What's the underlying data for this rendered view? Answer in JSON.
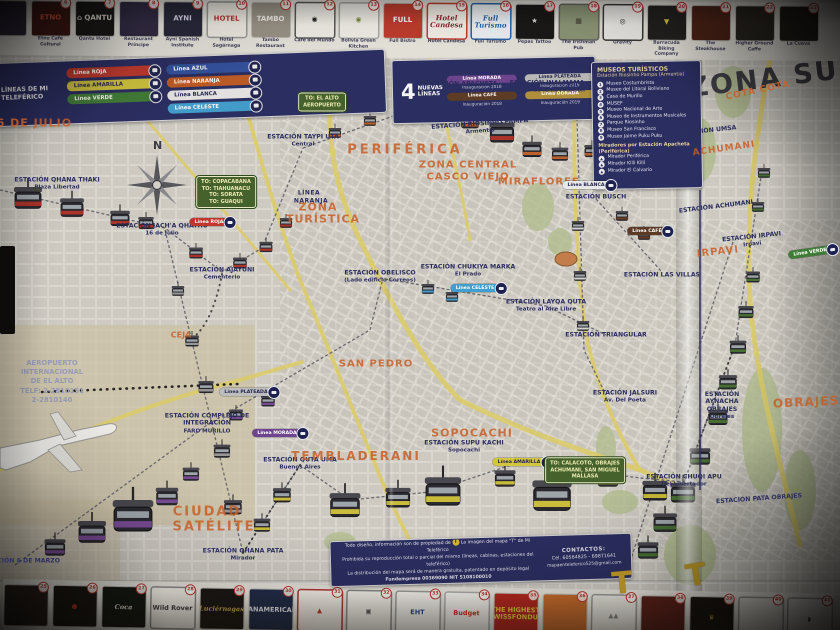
{
  "map": {
    "title": "LA PAZ",
    "right_title": "ZONA SUR",
    "compass_label": "N",
    "airport": {
      "lines": [
        "AEROPUERTO",
        "INTERNACIONAL",
        "DE EL ALTO",
        "TELF: 2-2810151",
        "2-2810140"
      ]
    },
    "stations": [
      {
        "name": "ESTACIÓN QHANA THAKI",
        "sub": "Plaza Libertad",
        "x": 57,
        "y": 184
      },
      {
        "name": "ESTACIÓN JACH'A QHATHU",
        "sub": "16 de Julio",
        "x": 162,
        "y": 230
      },
      {
        "name": "ESTACIÓN AJAYUNI",
        "sub": "Cementerio",
        "x": 222,
        "y": 274
      },
      {
        "name": "ESTACIÓN TAYPI UTA",
        "sub": "Central",
        "x": 303,
        "y": 141
      },
      {
        "name": "ESTACIÓN APACHETA",
        "sub": "Periférica",
        "x": 461,
        "y": 88
      },
      {
        "name": "ESTACIÓN INALMAMA",
        "sub": "Héroes de la Revolución",
        "x": 547,
        "y": 87
      },
      {
        "name": "ESTACIÓN RIOSINHO PAMPA",
        "sub": "Armentia",
        "x": 480,
        "y": 128,
        "rot": -4
      },
      {
        "name": "ESTACIÓN OBELISCO",
        "sub": "(Lado edificio Correos)",
        "x": 380,
        "y": 277
      },
      {
        "name": "ESTACIÓN CHUKIYA MARKA",
        "sub": "El Prado",
        "x": 468,
        "y": 271
      },
      {
        "name": "ESTACIÓN LAYQA QUTA",
        "sub": "Teatro al Aire Libre",
        "x": 546,
        "y": 306
      },
      {
        "name": "ESTACIÓN TRIANGULAR",
        "sub": "",
        "x": 606,
        "y": 335
      },
      {
        "name": "ESTACIÓN BUSCH",
        "sub": "",
        "x": 596,
        "y": 197
      },
      {
        "name": "ESTACIÓN LAS VILLAS",
        "sub": "",
        "x": 662,
        "y": 275
      },
      {
        "name": "ESTACIÓN SUPU KACHI",
        "sub": "Sopocachi",
        "x": 464,
        "y": 447
      },
      {
        "name": "ESTACIÓN QUTA UMA",
        "sub": "Buenos Aires",
        "x": 300,
        "y": 464
      },
      {
        "name": "ESTACIÓN QHANA PATA",
        "sub": "Mirador",
        "x": 243,
        "y": 555
      },
      {
        "name": "ESTACIÓN COMPLEJO DE INTEGRACIÓN",
        "sub": "FARO MURILLO",
        "x": 207,
        "y": 424,
        "w": 112
      },
      {
        "name": "ESTACIÓN JALSURI",
        "sub": "Av. Del Poeta",
        "x": 625,
        "y": 397
      },
      {
        "name": "ESTACIÓN CHUQI APU",
        "sub": "Del Libertador",
        "x": 684,
        "y": 481
      },
      {
        "name": "ESTACIÓN 6 DE MARZO",
        "sub": "",
        "x": 20,
        "y": 561
      },
      {
        "name": "ESTACIÓN UMSA",
        "sub": "",
        "x": 708,
        "y": 131,
        "rot": -6
      },
      {
        "name": "ESTACIÓN ACHUMANI",
        "sub": "",
        "x": 716,
        "y": 207,
        "rot": -7
      },
      {
        "name": "ESTACIÓN IRPAVI",
        "sub": "Irpavi",
        "x": 752,
        "y": 241,
        "rot": -6
      },
      {
        "name": "ESTACIÓN AYNACHA OBRAJES",
        "sub": "Obrajes",
        "x": 722,
        "y": 406,
        "w": 64
      },
      {
        "name": "ESTACIÓN PATA OBRAJES",
        "sub": "",
        "x": 759,
        "y": 499,
        "rot": -4
      }
    ],
    "zones": [
      {
        "label": "PERIFÉRICA",
        "x": 405,
        "y": 150,
        "fs": 13,
        "ls": 3
      },
      {
        "label": "ZONA CENTRAL",
        "x": 468,
        "y": 165,
        "fs": 10,
        "ls": 1
      },
      {
        "label": "CASCO VIEJO",
        "x": 468,
        "y": 177,
        "fs": 10,
        "ls": 1
      },
      {
        "label": "MIRAFLORES",
        "x": 539,
        "y": 182,
        "fs": 10,
        "ls": 1
      },
      {
        "label": "ZONA",
        "x": 318,
        "y": 207,
        "fs": 11,
        "ls": 1
      },
      {
        "label": "TURÍSTICA",
        "x": 323,
        "y": 219,
        "fs": 11,
        "ls": 1
      },
      {
        "label": "SAN PEDRO",
        "x": 376,
        "y": 364,
        "fs": 10,
        "ls": 1
      },
      {
        "label": "TEMBLADERANI",
        "x": 356,
        "y": 456,
        "fs": 12,
        "ls": 2
      },
      {
        "label": "SOPOCACHI",
        "x": 472,
        "y": 433,
        "fs": 11,
        "ls": 1
      },
      {
        "label": "CIUDAD",
        "x": 207,
        "y": 512,
        "fs": 13,
        "ls": 2
      },
      {
        "label": "SATÉLITE",
        "x": 214,
        "y": 527,
        "fs": 13,
        "ls": 2
      },
      {
        "label": "CEJA",
        "x": 181,
        "y": 335,
        "fs": 8,
        "ls": 0
      },
      {
        "label": "16 DE JULIO",
        "x": 30,
        "y": 123,
        "fs": 11,
        "ls": 1
      },
      {
        "label": "COTA COTA",
        "x": 758,
        "y": 91,
        "fs": 9,
        "ls": 1,
        "rot": -12
      },
      {
        "label": "ACHUMANI",
        "x": 724,
        "y": 149,
        "fs": 9,
        "ls": 1,
        "rot": -8
      },
      {
        "label": "IRPAVI",
        "x": 718,
        "y": 252,
        "fs": 10,
        "ls": 1,
        "rot": -6
      },
      {
        "label": "OBRAJES",
        "x": 806,
        "y": 402,
        "fs": 12,
        "ls": 1,
        "rot": -3
      }
    ],
    "line_labels": [
      {
        "label": "LÍNEA",
        "x": 309,
        "y": 193
      },
      {
        "label": "NARANJA",
        "x": 311,
        "y": 201
      }
    ],
    "tags": [
      {
        "label": "Línea ROJA",
        "color": "#c0372c",
        "x": 211,
        "y": 222
      },
      {
        "label": "Línea MORADA",
        "color": "#6e4390",
        "x": 279,
        "y": 433
      },
      {
        "label": "Línea PLATEADA",
        "color": "#bdbdbd",
        "x": 248,
        "y": 392,
        "dark": true
      },
      {
        "label": "Línea AMARILLA",
        "color": "#d3c63c",
        "x": 521,
        "y": 462,
        "dark": true
      },
      {
        "label": "Línea CELESTE",
        "color": "#3f9fd0",
        "x": 477,
        "y": 288
      },
      {
        "label": "Línea BLANCA",
        "color": "#e9e9e9",
        "x": 588,
        "y": 185,
        "dark": true
      },
      {
        "label": "Línea CAFÉ",
        "color": "#5c3a23",
        "x": 649,
        "y": 231
      },
      {
        "label": "Línea VERDE",
        "color": "#3f7d36",
        "x": 812,
        "y": 252,
        "rot": -8
      }
    ],
    "signs": [
      {
        "x": 322,
        "y": 102,
        "lines": [
          "TO: EL ALTO",
          "AEROPUERTO"
        ]
      },
      {
        "x": 226,
        "y": 192,
        "lines": [
          "TO: COPACABANA",
          "TO: TIAHUANACU",
          "TO: SORATA",
          "TO: GUAQUI"
        ]
      },
      {
        "x": 585,
        "y": 470,
        "lines": [
          "TO: CALACOTO, OBRAJES",
          "ACHUMANI, SAN MIGUEL",
          "MALLASA"
        ]
      }
    ]
  },
  "legend": {
    "title": "LÍNEAS DE MI TELEFÉRICO",
    "lines_left": [
      {
        "name": "Línea ROJA",
        "color": "#c0372c"
      },
      {
        "name": "Línea AMARILLA",
        "color": "#d3c63c",
        "dark": true
      },
      {
        "name": "Línea VERDE",
        "color": "#3f7d36"
      }
    ],
    "lines_right": [
      {
        "name": "Línea AZUL",
        "color": "#2f4f9e"
      },
      {
        "name": "Línea NARANJA",
        "color": "#bf5a22"
      },
      {
        "name": "Línea BLANCA",
        "color": "#e9e9e9",
        "dark": true
      },
      {
        "name": "Línea CELESTE",
        "color": "#3f9fd0"
      }
    ],
    "new_count": "4",
    "new_label": "NUEVAS LÍNEAS",
    "new_lines": [
      {
        "name": "Línea MORADA",
        "year": "Inauguración 2018",
        "color": "#6e4390"
      },
      {
        "name": "Línea PLATEADA",
        "year": "Inauguración 2019",
        "color": "#bdbdbd",
        "dark": true
      },
      {
        "name": "Línea CAFÉ",
        "year": "Inauguración 2018",
        "color": "#5c3a23"
      },
      {
        "name": "Línea DORADA",
        "year": "Inauguración 2019",
        "color": "#b3923a"
      }
    ]
  },
  "museums": {
    "title": "MUSEOS TURÍSTICOS",
    "subtitle": "Estación Riosinho Pampa (Armentia)",
    "items": [
      "Museo Costumbrista",
      "Museo del Litoral Boliviano",
      "Casa de Murillo",
      "MUSEF",
      "Museo Nacional de Arte",
      "Museo de Instrumentos Musicales",
      "Parque Riosinho",
      "Museo San Francisco",
      "Museo Jaime Puku Puku"
    ],
    "miradores_title": "Miradores por Estación Apacheta (Periférica)",
    "miradores": [
      "Mirador Periférica",
      "Mirador Killi Killi",
      "Mirador El Calvario"
    ]
  },
  "copyright": {
    "line1a": "Todo diseño, información son de propiedad de",
    "tlogo": "T",
    "line1b": "La imagen del mapa \"T\" de Mi Teleférico",
    "line2": "Prohibida su reproducción total o parcial del mismo (líneas, cabinas, estaciones del teleférico)",
    "line3": "La distribución del mapa será de manera gratuita, patentado en depósito legal",
    "line4": "Fundempresa 00369090    NIT 5108100010",
    "contact_title": "CONTACTOS:",
    "contact_phone": "Cel. 60564825 - 69871641",
    "contact_email": "mapaenteleferico525@gmail.com"
  },
  "top_ads": [
    {
      "num": "",
      "logo": "",
      "bg": "#2a2336",
      "fg": "#888",
      "caption": ""
    },
    {
      "num": "6",
      "logo": "ETNO",
      "bg": "#3a1410",
      "fg": "#d94f30",
      "caption": "Etno Café Cultural"
    },
    {
      "num": "7",
      "logo": "⌂ QANTU",
      "bg": "#141414",
      "fg": "#e8e4da",
      "caption": "Qantu Hotel"
    },
    {
      "num": "8",
      "logo": "",
      "bg": "#2e2742",
      "fg": "#cfcbe0",
      "caption": "Restaurant Príncipe"
    },
    {
      "num": "9",
      "logo": "AYNI",
      "bg": "#242438",
      "fg": "#dcd8ee",
      "caption": "Ayni Spanish Institute"
    },
    {
      "num": "10",
      "logo": "HOTEL",
      "bg": "#f2efe8",
      "fg": "#b03530",
      "caption": "Hotel Sagárnaga",
      "border": "#999999"
    },
    {
      "num": "11",
      "logo": "TAMBO",
      "bg": "#9a9488",
      "fg": "#f5f3ee",
      "caption": "Tambo Restaurant"
    },
    {
      "num": "12",
      "logo": "◉",
      "bg": "#f4f2ec",
      "fg": "#1a1a1a",
      "caption": "Café del Mundo",
      "border": "#555555"
    },
    {
      "num": "13",
      "logo": "◉",
      "bg": "#f4f2ec",
      "fg": "#7a8f3c",
      "caption": "Bolivia Green Kitchen",
      "border": "#aaaaaa"
    },
    {
      "num": "14",
      "logo": "FULL",
      "bg": "#c0392b",
      "fg": "#ffffff",
      "caption": "Full Bistro"
    },
    {
      "num": "15",
      "logo": "Hotel Candesa",
      "bg": "#f6f3ec",
      "fg": "#8a2430",
      "caption": "Hotel Candesa",
      "border": "#c0392b",
      "script": true
    },
    {
      "num": "16",
      "logo": "Full Turismo",
      "bg": "#f2f6fa",
      "fg": "#2262a8",
      "caption": "Full Turismo",
      "border": "#2262a8",
      "script": true
    },
    {
      "num": "17",
      "logo": "★",
      "bg": "#141414",
      "fg": "#e8e8e8",
      "caption": "Pepas Tattoo"
    },
    {
      "num": "18",
      "logo": "▦",
      "bg": "#8f9a7a",
      "fg": "#3c3c2e",
      "caption": "The Irishman Pub",
      "border": "#666666"
    },
    {
      "num": "19",
      "logo": "◎",
      "bg": "#f2f2f0",
      "fg": "#222222",
      "caption": "Gravity",
      "border": "#333333"
    },
    {
      "num": "20",
      "logo": "▼",
      "bg": "#1c1c1c",
      "fg": "#d8c33a",
      "caption": "Barracuda Biking Company"
    },
    {
      "num": "21",
      "logo": "",
      "bg": "#4a1f14",
      "fg": "#d8d0c0",
      "caption": "The Steakhouse"
    },
    {
      "num": "22",
      "logo": "",
      "bg": "#26221e",
      "fg": "#cfc9c0",
      "caption": "Higher Ground Caffe"
    },
    {
      "num": "23",
      "logo": "",
      "bg": "#1e1a16",
      "fg": "#d0cac0",
      "caption": "La Cueva"
    }
  ],
  "bottom_ads": [
    {
      "num": "25",
      "logo": "",
      "bg": "#241c18",
      "fg": "#777777"
    },
    {
      "num": "26",
      "logo": "●",
      "bg": "#16120e",
      "fg": "#c03024"
    },
    {
      "num": "27",
      "logo": "Coca",
      "bg": "#10140e",
      "fg": "#e8e4d8",
      "script": true
    },
    {
      "num": "28",
      "logo": "Wild Rover",
      "bg": "#efece4",
      "fg": "#3a3a3a",
      "border": "#888888"
    },
    {
      "num": "29",
      "logo": "Luciérnagas",
      "bg": "#151210",
      "fg": "#c9a94a",
      "script": true
    },
    {
      "num": "30",
      "logo": "PANAMERICAN",
      "bg": "#1c2846",
      "fg": "#e8e8f0"
    },
    {
      "num": "31",
      "logo": "▲",
      "bg": "#f2efe8",
      "fg": "#c03a20",
      "border": "#b03030"
    },
    {
      "num": "32",
      "logo": "▣",
      "bg": "#f1efe9",
      "fg": "#555555",
      "border": "#888888"
    },
    {
      "num": "33",
      "logo": "EHT",
      "bg": "#f4f2ee",
      "fg": "#23408f",
      "border": "#999999"
    },
    {
      "num": "34",
      "logo": "Budget",
      "bg": "#f7f5f1",
      "fg": "#d02a20",
      "border": "#aaaaaa"
    },
    {
      "num": "35",
      "logo": "THE HIGHEST SWISSFONDUE",
      "bg": "#b5231c",
      "fg": "#f0d23c"
    },
    {
      "num": "36",
      "logo": "",
      "bg": "#c96a2a",
      "fg": "#eeeeee"
    },
    {
      "num": "37",
      "logo": "▲▲",
      "bg": "#eeece6",
      "fg": "#8a8a86",
      "border": "#999999"
    },
    {
      "num": "38",
      "logo": "",
      "bg": "#5a1c16",
      "fg": "#cccccc"
    },
    {
      "num": "39",
      "logo": "♛",
      "bg": "#14100c",
      "fg": "#c9a23a"
    },
    {
      "num": "40",
      "logo": "",
      "bg": "#e9e6df",
      "fg": "#555555",
      "border": "#999999"
    },
    {
      "num": "41",
      "logo": "◗",
      "bg": "#efede7",
      "fg": "#333333",
      "border": "#999999"
    }
  ]
}
